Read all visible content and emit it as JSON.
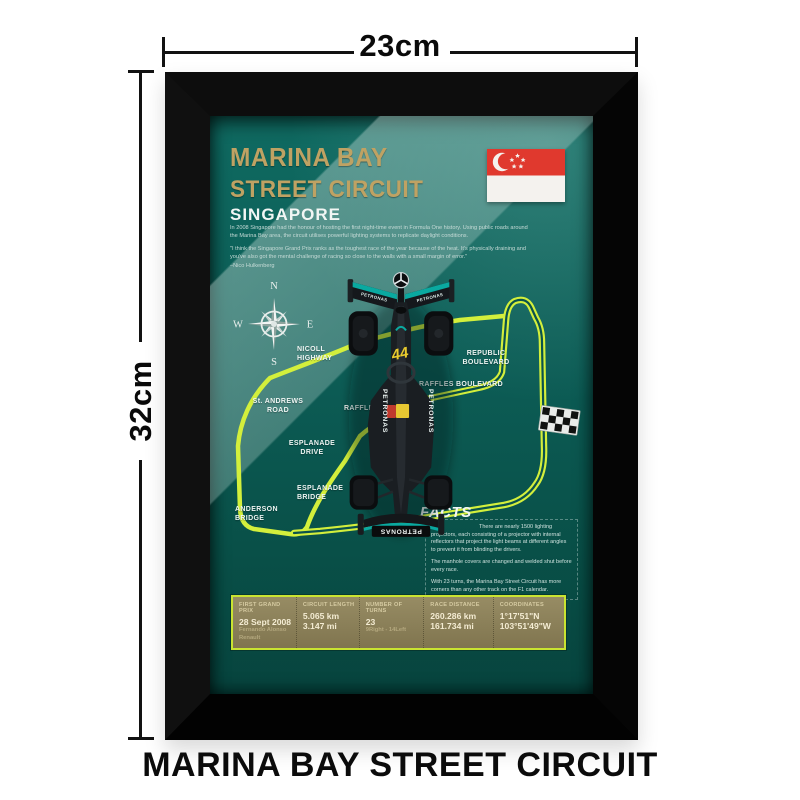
{
  "dimensions": {
    "width_label": "23cm",
    "height_label": "32cm"
  },
  "caption": "MARINA BAY STREET CIRCUIT",
  "colors": {
    "track_neon": "#d3ef3c",
    "title_gold": "#bfa263",
    "poster_teal": "#0c5c55",
    "table_border": "#c9e431",
    "car_accent": "#0aa9a0",
    "flag_red": "#e0392e"
  },
  "poster": {
    "title1": "MARINA BAY",
    "title2": "STREET CIRCUIT",
    "title3": "SINGAPORE",
    "intro": {
      "p1": "In 2008 Singapore had the honour of hosting the first night-time event in Formula One history. Using public roads around the Marina Bay area, the circuit utilises powerful lighting systems to replicate daylight conditions.",
      "quote": "\"I think the Singapore Grand Prix ranks as the toughest race of the year because of the heat. It's physically draining and you've also got the mental challenge of racing so close to the walls with a small margin of error.\"",
      "attribution": "–Nico Hulkenberg"
    },
    "compass": {
      "n": "N",
      "e": "E",
      "s": "S",
      "w": "W"
    },
    "roads": [
      "NICOLL HIGHWAY",
      "St. ANDREWS ROAD",
      "RAFFLES AVENUE",
      "RAFFLES BOULEVARD",
      "ESPLANADE DRIVE",
      "ESPLANADE BRIDGE",
      "ANDERSON BRIDGE",
      "REPUBLIC BOULEVARD"
    ],
    "facts": {
      "heading": "FACTS",
      "items": [
        "There are nearly 1500 lighting projectors, each consisting of a projector with internal reflectors that project the light beams at different angles to prevent it from blinding the drivers.",
        "The manhole covers are changed and welded shut before every race.",
        "With 23 turns, the Marina Bay Street Circuit has more corners than any other track on the F1 calendar."
      ]
    },
    "stats": [
      {
        "label": "FIRST GRAND PRIX",
        "value": "28 Sept 2008",
        "sub1": "Fernando Alonso",
        "sub2": "Renault"
      },
      {
        "label": "CIRCUIT LENGTH",
        "value": "5.065 km",
        "sub1": "3.147 mi",
        "sub2": ""
      },
      {
        "label": "NUMBER OF TURNS",
        "value": "23",
        "sub1": "9Right - 14Left",
        "sub2": ""
      },
      {
        "label": "RACE DISTANCE",
        "value": "260.286 km",
        "sub1": "161.734 mi",
        "sub2": ""
      },
      {
        "label": "COORDINATES",
        "value": "1°17'51\"N",
        "sub1": "103°51'49\"W",
        "sub2": ""
      }
    ],
    "car": {
      "number": "44",
      "brand": "PETRONAS"
    }
  }
}
